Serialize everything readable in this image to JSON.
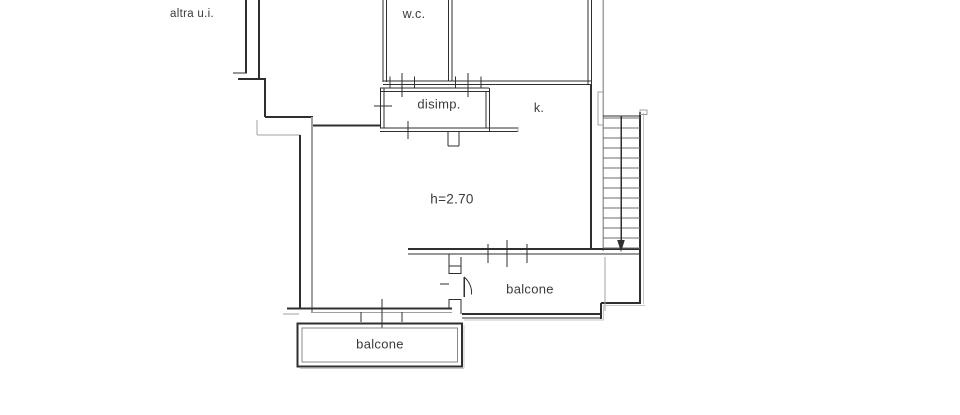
{
  "colors": {
    "wall": "#2f2f2f",
    "gray": "#a0a0a0",
    "mid": "#8a8a8a",
    "shadow": "#c8c8c8",
    "step": "#6e6e6e",
    "text": "#3a3a3a",
    "background": "#ffffff"
  },
  "labels": [
    {
      "id": "other-unit",
      "text": "altra u.i.",
      "x": 192,
      "y": 14,
      "size": 11.5
    },
    {
      "id": "wc",
      "text": "w.c.",
      "x": 414,
      "y": 14,
      "size": 12.5
    },
    {
      "id": "disimpegno",
      "text": "disimp.",
      "x": 439,
      "y": 104,
      "size": 13
    },
    {
      "id": "kitchen",
      "text": "k.",
      "x": 539,
      "y": 108,
      "size": 12.5
    },
    {
      "id": "ceiling-height",
      "text": "h=2.70",
      "x": 452,
      "y": 199,
      "size": 13.5
    },
    {
      "id": "balcony-right",
      "text": "balcone",
      "x": 530,
      "y": 289,
      "size": 13
    },
    {
      "id": "balcony-bottom",
      "text": "balcone",
      "x": 380,
      "y": 344,
      "size": 13
    }
  ],
  "plan": {
    "width": 960,
    "height": 415,
    "segments": [
      [
        246,
        0,
        246,
        73,
        1.6,
        "wall"
      ],
      [
        259,
        0,
        259,
        78,
        1.6,
        "wall"
      ],
      [
        233,
        73,
        247,
        73,
        1.4,
        "wall"
      ],
      [
        238,
        79,
        266,
        79,
        1.8,
        "wall"
      ],
      [
        265,
        79,
        265,
        117,
        1.6,
        "wall"
      ],
      [
        265,
        117,
        313,
        117,
        1.8,
        "wall"
      ],
      [
        257,
        120,
        257,
        135,
        1.4,
        "gray"
      ],
      [
        257,
        135,
        300,
        135,
        1.4,
        "gray"
      ],
      [
        300,
        135,
        300,
        308,
        1.6,
        "wall"
      ],
      [
        312,
        117,
        312,
        313,
        1.6,
        "gray"
      ],
      [
        313,
        125.5,
        381,
        125.5,
        2,
        "wall"
      ],
      [
        383,
        0,
        383,
        82,
        1.3,
        "wall"
      ],
      [
        386.5,
        0,
        386.5,
        82,
        1.3,
        "wall"
      ],
      [
        448.5,
        0,
        448.5,
        81,
        1.3,
        "wall"
      ],
      [
        452,
        0,
        452,
        81,
        1.3,
        "wall"
      ],
      [
        588,
        0,
        588,
        84,
        1.3,
        "wall"
      ],
      [
        591.5,
        0,
        591.5,
        84,
        1.3,
        "wall"
      ],
      [
        383,
        81,
        452,
        81,
        1.3,
        "wall"
      ],
      [
        383,
        84.5,
        452,
        84.5,
        1.3,
        "wall"
      ],
      [
        452,
        81,
        591.5,
        81,
        1.3,
        "wall"
      ],
      [
        452,
        84.5,
        591.5,
        84.5,
        1.3,
        "wall"
      ],
      [
        591,
        84,
        591,
        250,
        1.8,
        "wall"
      ],
      [
        603,
        0,
        603,
        251,
        1.5,
        "gray"
      ],
      [
        380,
        88,
        489,
        88,
        1.3,
        "wall"
      ],
      [
        380,
        91.5,
        489,
        91.5,
        1.3,
        "wall"
      ],
      [
        380.5,
        88,
        380.5,
        128,
        1.3,
        "wall"
      ],
      [
        384,
        88,
        384,
        128,
        1.3,
        "wall"
      ],
      [
        486,
        91,
        486,
        128,
        1.3,
        "wall"
      ],
      [
        489.5,
        88,
        489.5,
        131,
        1.3,
        "wall"
      ],
      [
        380,
        128,
        518,
        128,
        1.4,
        "wall"
      ],
      [
        380,
        131.5,
        518,
        131.5,
        1.4,
        "wall"
      ],
      [
        518,
        127,
        518,
        132,
        1.2,
        "gray"
      ],
      [
        402,
        73,
        402,
        97,
        1.2,
        "wall"
      ],
      [
        390,
        76.5,
        390,
        88,
        1,
        "wall"
      ],
      [
        414.5,
        76.5,
        414.5,
        88,
        1,
        "wall"
      ],
      [
        468,
        73,
        468,
        97,
        1.2,
        "wall"
      ],
      [
        455.5,
        76.5,
        455.5,
        88,
        1,
        "wall"
      ],
      [
        481,
        76.5,
        481,
        88,
        1,
        "wall"
      ],
      [
        374,
        106,
        392,
        106,
        1.2,
        "wall"
      ],
      [
        408,
        121,
        408,
        139,
        1.2,
        "wall"
      ],
      [
        448,
        131.5,
        448,
        146,
        1.3,
        "wall"
      ],
      [
        459,
        131.5,
        459,
        146,
        1.3,
        "wall"
      ],
      [
        448,
        146,
        459,
        146,
        1.3,
        "wall"
      ],
      [
        287,
        308.5,
        452,
        308.5,
        1.7,
        "wall"
      ],
      [
        311,
        312.5,
        452,
        312.5,
        1.4,
        "gray"
      ],
      [
        283,
        314,
        299,
        314,
        1.2,
        "gray"
      ],
      [
        361,
        312,
        361,
        322,
        1.1,
        "wall"
      ],
      [
        382,
        299,
        382,
        328,
        1.1,
        "wall"
      ],
      [
        402,
        312,
        402,
        322,
        1.1,
        "wall"
      ],
      [
        408,
        249,
        641,
        249,
        1.6,
        "wall"
      ],
      [
        408,
        254,
        641,
        254,
        1.4,
        "wall"
      ],
      [
        488,
        244,
        488,
        263,
        1.1,
        "wall"
      ],
      [
        507,
        240,
        507,
        267,
        1.1,
        "wall"
      ],
      [
        527,
        244,
        527,
        263,
        1.1,
        "wall"
      ],
      [
        449,
        254,
        449,
        274,
        1.4,
        "wall"
      ],
      [
        449,
        299,
        449,
        308,
        1.4,
        "wall"
      ],
      [
        461,
        257,
        461,
        274,
        1.4,
        "wall"
      ],
      [
        461,
        299,
        461,
        314,
        1.4,
        "wall"
      ],
      [
        449,
        266,
        461,
        266,
        1.2,
        "wall"
      ],
      [
        449,
        273.5,
        461,
        273.5,
        1.2,
        "wall"
      ],
      [
        449,
        299.5,
        461,
        299.5,
        1.2,
        "wall"
      ],
      [
        440,
        284,
        449,
        284,
        1,
        "wall"
      ],
      [
        464,
        277,
        464,
        297,
        1.5,
        "wall"
      ],
      [
        462,
        314,
        601,
        314,
        1.6,
        "wall"
      ],
      [
        462,
        318,
        600,
        318,
        1.4,
        "wall"
      ],
      [
        601,
        303,
        601,
        319,
        1.6,
        "wall"
      ],
      [
        601,
        303,
        641,
        303,
        1.6,
        "wall"
      ],
      [
        640,
        112,
        640,
        303,
        1.8,
        "wall"
      ],
      [
        605,
        257,
        605,
        311,
        1.4,
        "gray"
      ],
      [
        643.5,
        113,
        643.5,
        304,
        1.2,
        "shadow"
      ],
      [
        603,
        305.5,
        645,
        305.5,
        1.2,
        "shadow"
      ],
      [
        603.5,
        305,
        603.5,
        320,
        1.2,
        "shadow"
      ],
      [
        464,
        320,
        604,
        320,
        1.2,
        "shadow"
      ],
      [
        464,
        325,
        464,
        368,
        1.2,
        "shadow"
      ],
      [
        300,
        368.5,
        464,
        368.5,
        1.2,
        "shadow"
      ]
    ],
    "rects": [
      {
        "x": 297.5,
        "y": 323.5,
        "w": 164.5,
        "h": 43,
        "sw": 1.8,
        "c": "wall",
        "name": "balcony-bottom-outline"
      },
      {
        "x": 302,
        "y": 328,
        "w": 155.5,
        "h": 34,
        "sw": 1.1,
        "c": "mid",
        "name": "balcony-bottom-inner"
      },
      {
        "x": 598,
        "y": 92,
        "w": 5,
        "h": 33,
        "sw": 1.2,
        "c": "gray",
        "name": "entrance-door"
      },
      {
        "x": 640,
        "y": 110,
        "w": 7,
        "h": 4.5,
        "sw": 1,
        "c": "gray",
        "name": "stair-wall-cap"
      }
    ],
    "stairs": {
      "x1": 603,
      "x2": 640,
      "top_y": 116,
      "first_step_y": 118,
      "step_count": 14,
      "step_dy": 10,
      "rail_x": 621,
      "rail_y1": 116,
      "rail_y2": 240,
      "arrow_half_w": 3.8,
      "arrow_tip_y": 252
    },
    "door_swing": {
      "x": 464,
      "y_top": 277,
      "x_end": 471.5,
      "y_end": 294.5,
      "r": 20
    }
  }
}
